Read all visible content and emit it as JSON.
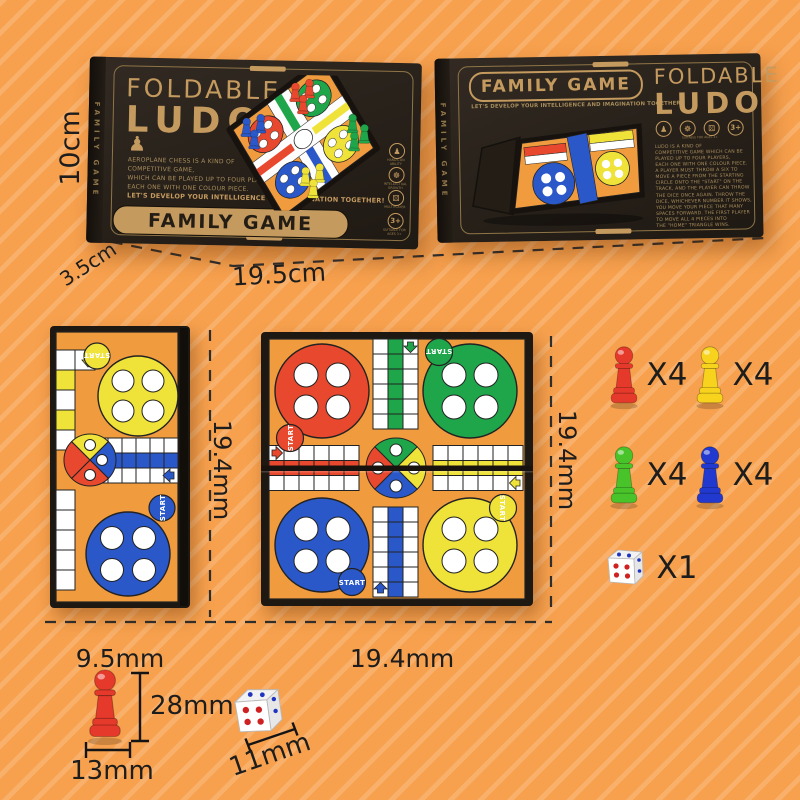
{
  "colors": {
    "background": "#F7A14E",
    "stripe": "#FAB269",
    "box": "#2A231C",
    "gold": "#C49A5F",
    "board": "#F09C3E",
    "red": "#E8482E",
    "green": "#1FA64B",
    "blue": "#2B58C8",
    "yellow": "#EFE238",
    "piece_red": "#E5392B",
    "piece_yellow": "#F7D31D",
    "piece_green": "#49C32A",
    "piece_blue": "#2239D0",
    "ink": "#1D1D1D"
  },
  "front_box": {
    "spine": "FAMILY GAME",
    "title_line1": "FOLDABLE",
    "title_line2": "LUDO",
    "pawn_icon": "♟",
    "description": "AEROPLANE CHESS IS A KIND OF\nCOMPETITIVE GAME,\nWHICH CAN BE PLAYED UP TO FOUR PLAYERS,\nEACH ONE WITH ONE COLOUR PIECE.",
    "slogan": "LET'S DEVELOP YOUR INTELLIGENCE AND IMAGINATION TOGETHER!",
    "badge": "FAMILY GAME",
    "icons": [
      {
        "glyph": "♟",
        "caption": "HANDS-ON ABILITY"
      },
      {
        "glyph": "☸",
        "caption": "INTELLECTUAL GROWTH"
      },
      {
        "glyph": "⚄",
        "caption": "MULTIPLAYER"
      },
      {
        "glyph": "3+",
        "caption": "SUITABLE FOR AGES 3+"
      }
    ]
  },
  "back_box": {
    "spine": "FAMILY GAME",
    "badge": "FAMILY GAME",
    "slogan": "LET'S DEVELOP YOUR INTELLIGENCE AND IMAGINATION TOGETHER!",
    "title_line1": "FOLDABLE",
    "title_line2": "LUDO",
    "icons": [
      {
        "glyph": "♟",
        "caption": "HANDS-ON ABILITY"
      },
      {
        "glyph": "☸",
        "caption": "INTELLECTUAL GROWTH"
      },
      {
        "glyph": "⚄",
        "caption": "MULTIPLAYER"
      },
      {
        "glyph": "3+",
        "caption": "SUITABLE FOR AGES 3+"
      }
    ],
    "rules": "LUDO IS A KIND OF\nCOMPETITIVE GAME WHICH CAN BE\nPLAYED UP TO FOUR PLAYERS,\nEACH ONE WITH ONE COLOUR PIECE.\nA PLAYER MUST THROW A SIX TO\nMOVE A PIECE FROM THE STARTING\nCIRCLE ONTO THE \"START\" ON THE\nTRACK, AND THE PLAYER CAN THROW\nTHE DICE ONCE AGAIN. THROW THE\nDICE, WHICHEVER NUMBER IT SHOWS,\nYOU MOVE YOUR PIECE THAT MANY\nSPACES FORWARD. THE FIRST PLAYER\nTO MOVE ALL 4 PIECES INTO\nTHE \"HOME\" TRIANGLE WINS."
  },
  "board": {
    "start_label": "START"
  },
  "dimensions": {
    "box_height": "10cm",
    "box_depth": "3.5cm",
    "box_width": "19.5cm",
    "folded_board_width": "9.5mm",
    "board_height_left": "19.4mm",
    "open_board_width": "19.4mm",
    "board_height_right": "19.4mm",
    "pawn_height": "28mm",
    "pawn_base": "13mm",
    "dice_size": "11mm"
  },
  "contents": {
    "pieces": [
      {
        "name": "red-pawn",
        "count": "X4",
        "color": "#E5392B"
      },
      {
        "name": "yellow-pawn",
        "count": "X4",
        "color": "#F7D31D"
      },
      {
        "name": "green-pawn",
        "count": "X4",
        "color": "#49C32A"
      },
      {
        "name": "blue-pawn",
        "count": "X4",
        "color": "#2239D0"
      }
    ],
    "dice": {
      "name": "dice",
      "count": "X1"
    }
  }
}
